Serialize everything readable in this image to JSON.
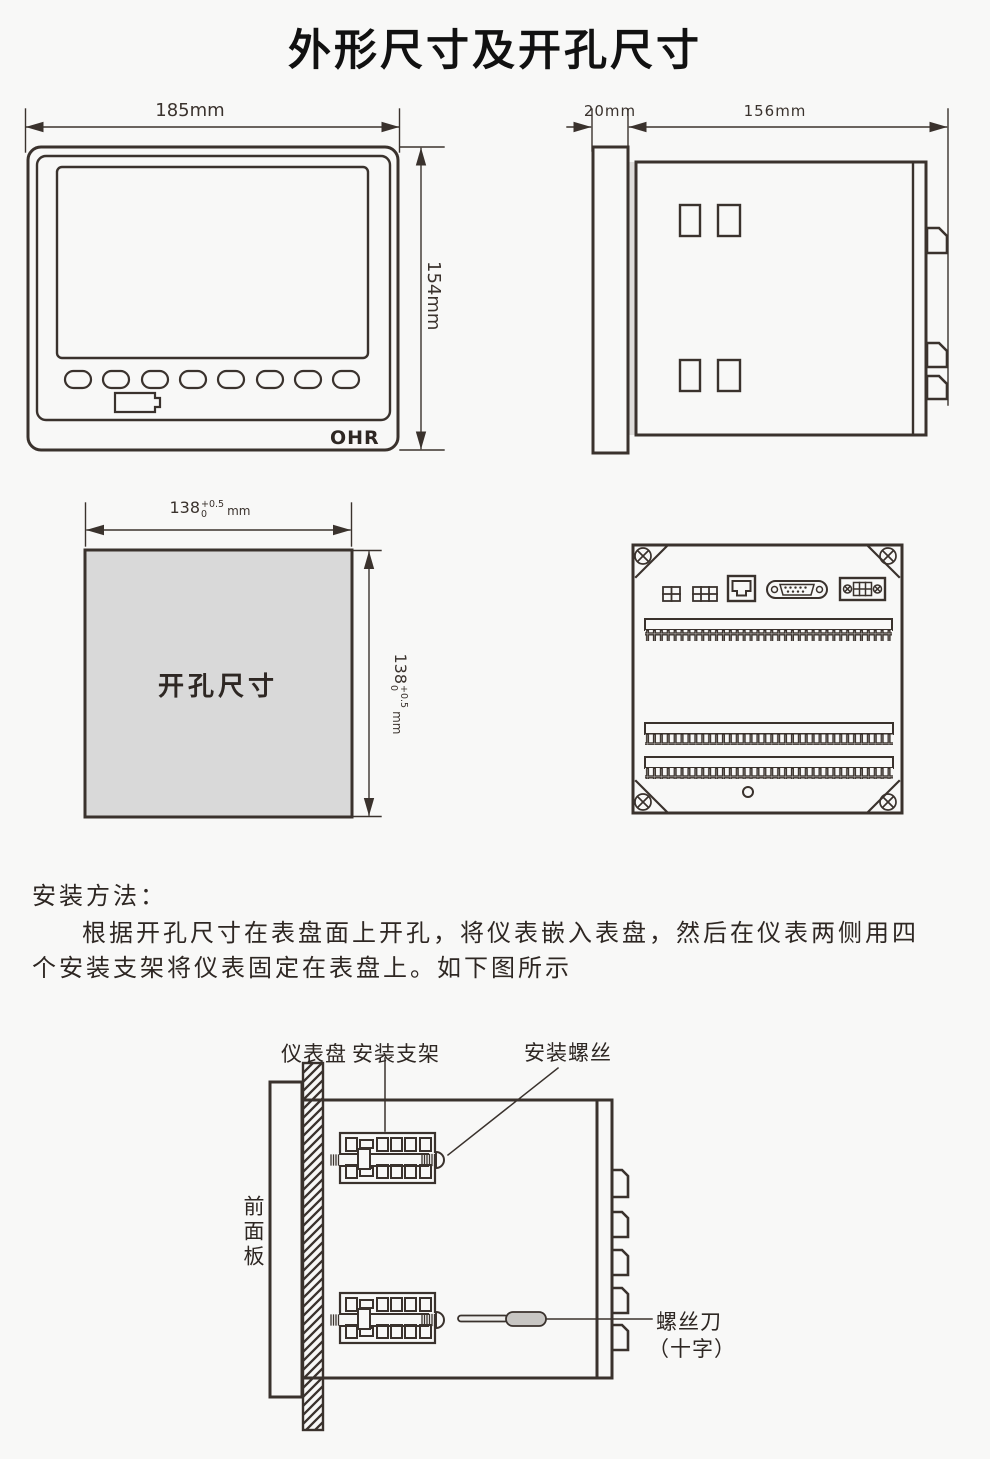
{
  "title": "外形尺寸及开孔尺寸",
  "front_view": {
    "width_label": "185mm",
    "height_label": "154mm",
    "brand": "OHR"
  },
  "side_view": {
    "panel_thickness_label": "20mm",
    "depth_label": "156mm"
  },
  "cutout": {
    "label": "开孔尺寸",
    "width_dim": {
      "value": "138",
      "tol_upper": "+0.5",
      "tol_lower": "0",
      "unit": "mm"
    },
    "height_dim": {
      "value": "138",
      "tol_upper": "+0.5",
      "tol_lower": "0",
      "unit": "mm"
    }
  },
  "installation": {
    "heading": "安装方法：",
    "line1": "根据开孔尺寸在表盘面上开孔，将仪表嵌入表盘，然后在仪表两侧用四",
    "line2": "个安装支架将仪表固定在表盘上。如下图所示",
    "labels": {
      "panel": "仪表盘",
      "bracket": "安装支架",
      "screw": "安装螺丝",
      "front_panel": "前面板",
      "screwdriver": "螺丝刀",
      "screwdriver_type": "（十字）"
    }
  },
  "colors": {
    "line": "#3a322d",
    "cutout_fill": "#d9d9d9",
    "background": "#f8f8f7"
  }
}
